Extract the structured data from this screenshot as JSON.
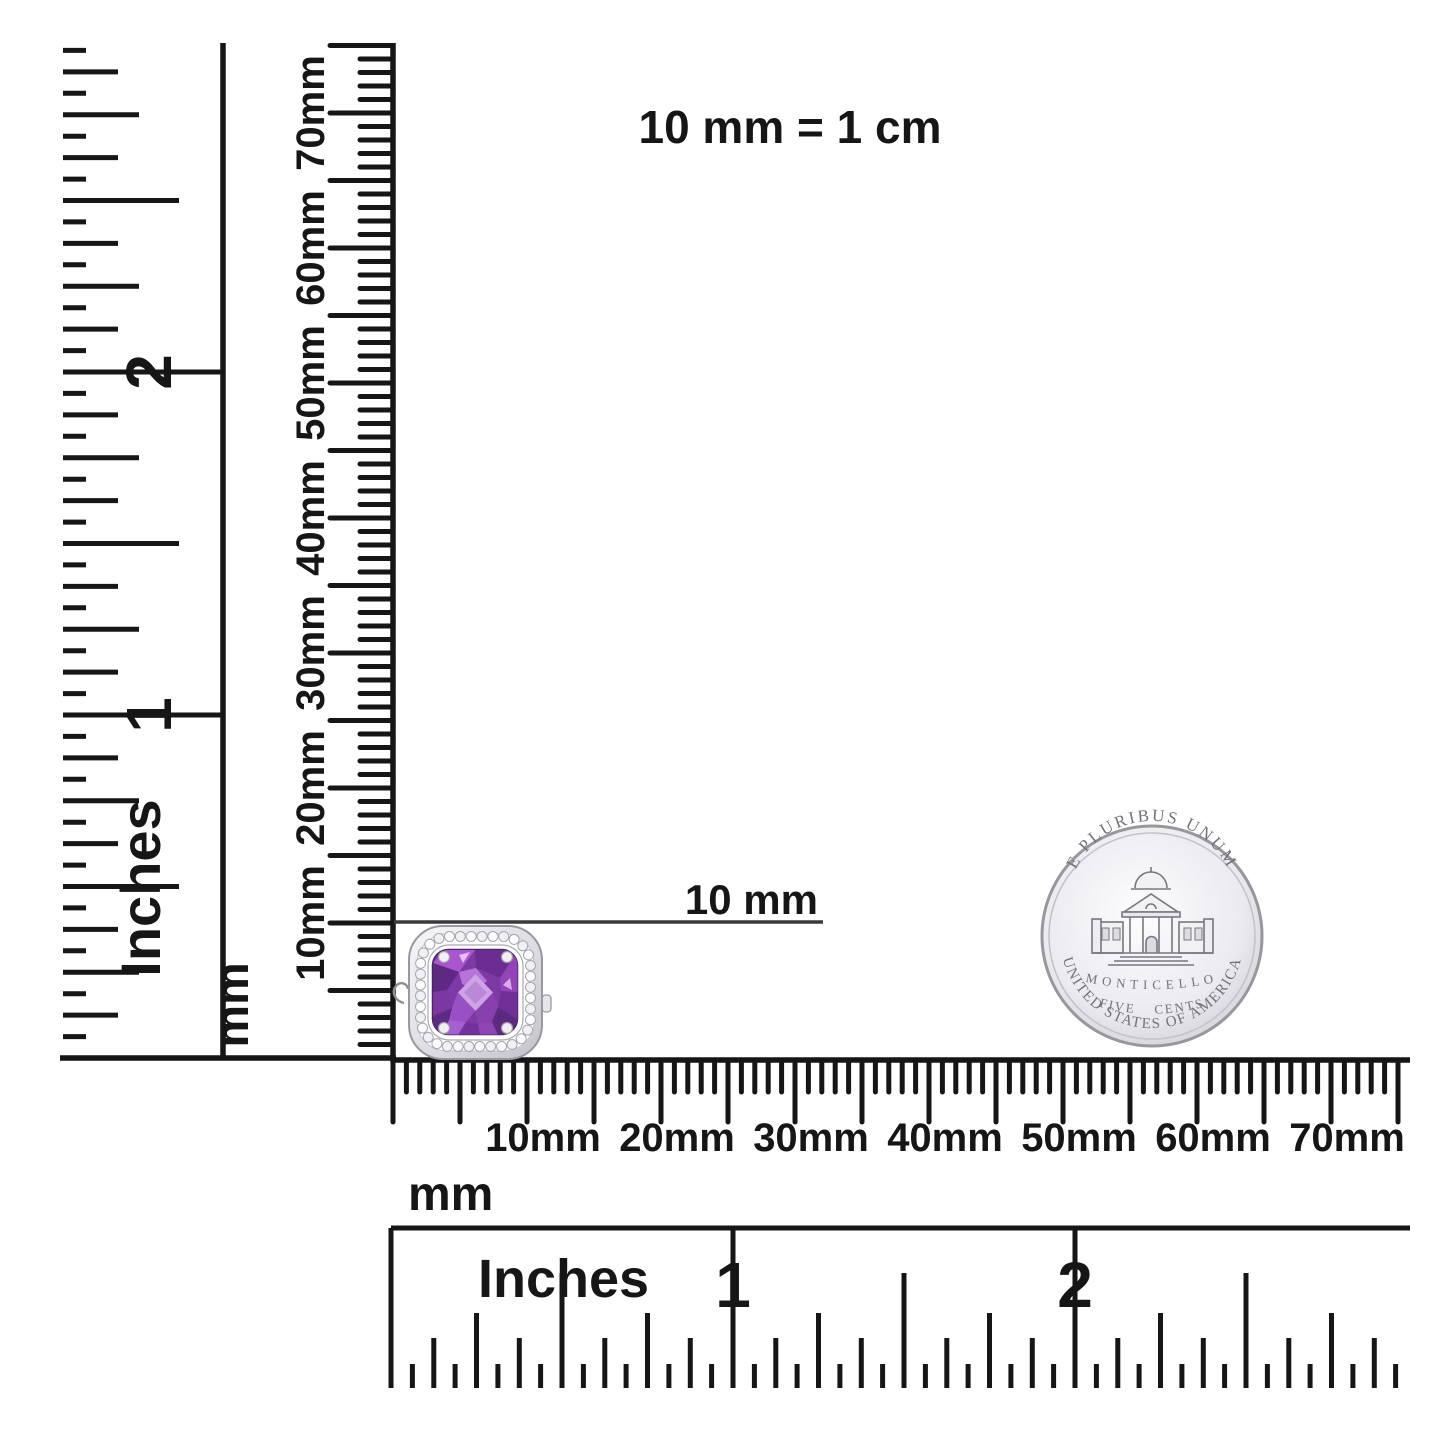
{
  "note": {
    "text": "10 mm = 1 cm"
  },
  "annotation": {
    "text": "10 mm"
  },
  "rulers": {
    "left_inches": {
      "unit": "Inches",
      "numbers": [
        "1",
        "2"
      ]
    },
    "left_mm": {
      "unit": "mm",
      "labels": [
        "10mm",
        "20mm",
        "30mm",
        "40mm",
        "50mm",
        "60mm",
        "70mm"
      ]
    },
    "bottom_mm": {
      "unit": "mm",
      "labels": [
        "10mm",
        "20mm",
        "30mm",
        "40mm",
        "50mm",
        "60mm",
        "70mm"
      ]
    },
    "bottom_inches": {
      "unit": "Inches",
      "numbers": [
        "1",
        "2"
      ]
    }
  },
  "coin": {
    "top_text": "E PLURIBUS UNUM",
    "building_label": "MONTICELLO",
    "denomination": "FIVE CENTS",
    "bottom_text": "UNITED STATES OF AMERICA"
  },
  "jewelry": {
    "gem_color": "#7e3aa4",
    "gem_light_color": "#cda3e4",
    "gem_dark_color": "#5d2982",
    "metal_color": "#e9e9ee",
    "diamond_color": "#fcfcfe"
  },
  "ink_color": "#161616"
}
